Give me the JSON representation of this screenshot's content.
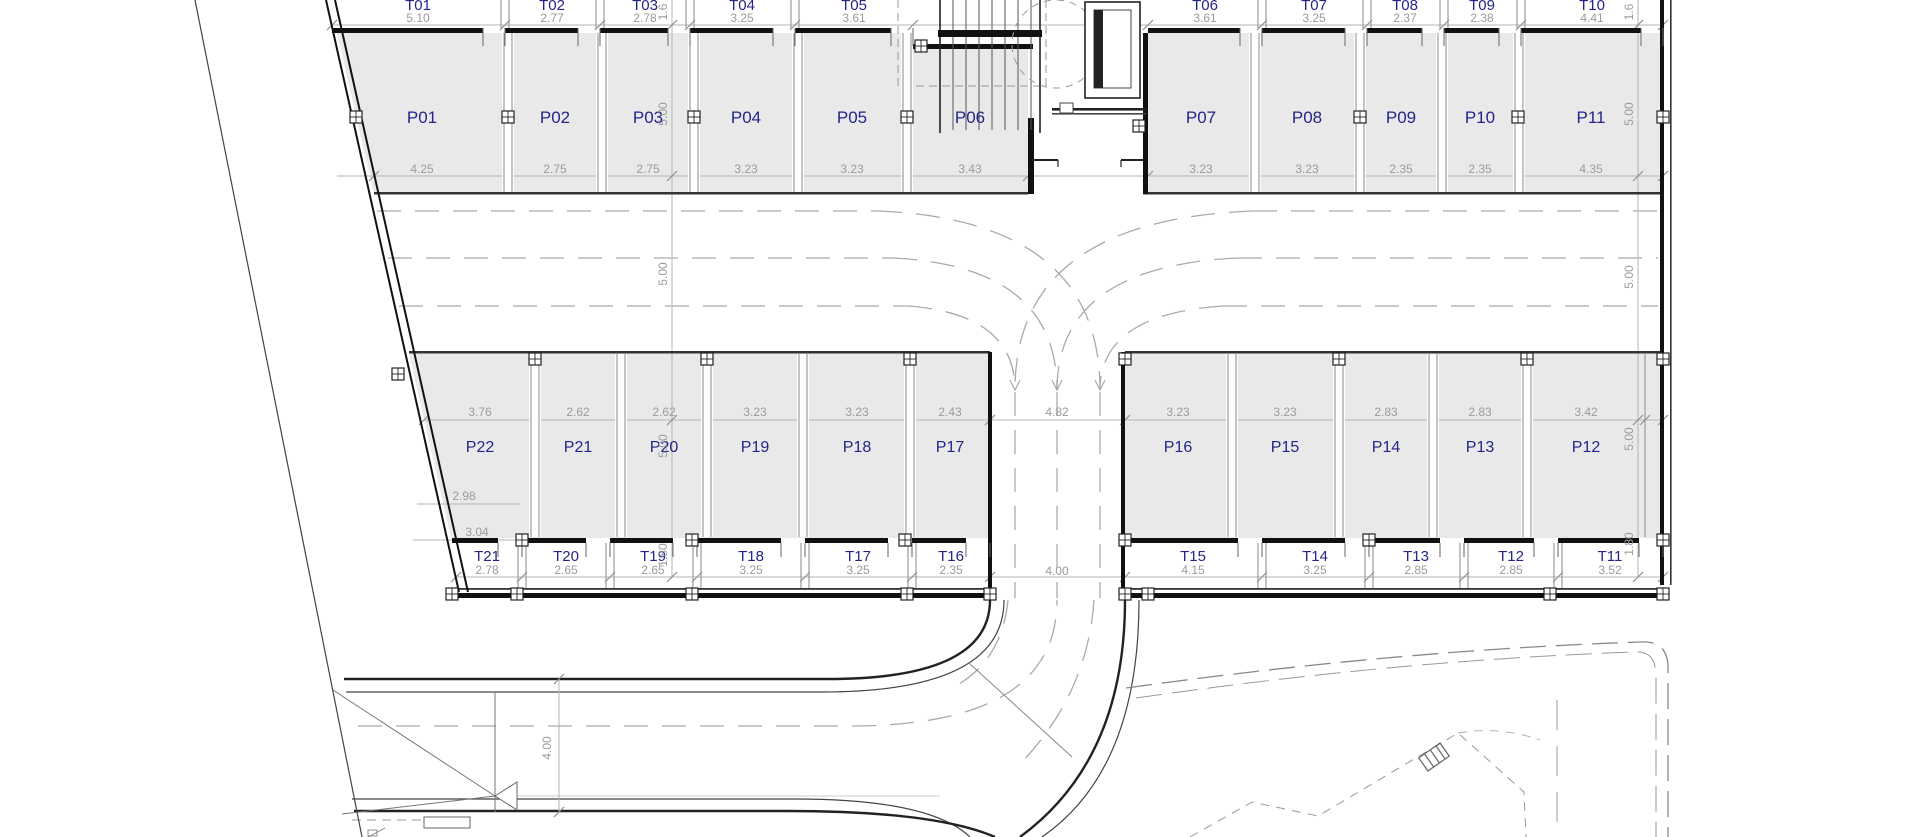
{
  "plan": {
    "title": "parking-level-floor-plan",
    "top_storage_row": [
      {
        "id": "T01",
        "w": "5.10"
      },
      {
        "id": "T02",
        "w": "2.77"
      },
      {
        "id": "T03",
        "w": "2.78"
      },
      {
        "id": "T04",
        "w": "3.25"
      },
      {
        "id": "T05",
        "w": "3.61"
      },
      {
        "id": "T06",
        "w": "3.61"
      },
      {
        "id": "T07",
        "w": "3.25"
      },
      {
        "id": "T08",
        "w": "2.37"
      },
      {
        "id": "T09",
        "w": "2.38"
      },
      {
        "id": "T10",
        "w": "4.41"
      }
    ],
    "top_parking_row": [
      {
        "id": "P01",
        "w": "4.25"
      },
      {
        "id": "P02",
        "w": "2.75"
      },
      {
        "id": "P03",
        "w": "2.75"
      },
      {
        "id": "P04",
        "w": "3.23"
      },
      {
        "id": "P05",
        "w": "3.23"
      },
      {
        "id": "P06",
        "w": "3.43"
      },
      {
        "id": "P07",
        "w": "3.23"
      },
      {
        "id": "P08",
        "w": "3.23"
      },
      {
        "id": "P09",
        "w": "2.35"
      },
      {
        "id": "P10",
        "w": "2.35"
      },
      {
        "id": "P11",
        "w": "4.35"
      }
    ],
    "bottom_parking_row": [
      {
        "id": "P22",
        "w": "3.76"
      },
      {
        "id": "P21",
        "w": "2.62"
      },
      {
        "id": "P20",
        "w": "2.62"
      },
      {
        "id": "P19",
        "w": "3.23"
      },
      {
        "id": "P18",
        "w": "3.23"
      },
      {
        "id": "P17",
        "w": "2.43"
      },
      {
        "id": "P16",
        "w": "3.23"
      },
      {
        "id": "P15",
        "w": "3.23"
      },
      {
        "id": "P14",
        "w": "2.83"
      },
      {
        "id": "P13",
        "w": "2.83"
      },
      {
        "id": "P12",
        "w": "3.42"
      }
    ],
    "bottom_storage_row": [
      {
        "id": "T21",
        "w": "2.78"
      },
      {
        "id": "T20",
        "w": "2.65"
      },
      {
        "id": "T19",
        "w": "2.65"
      },
      {
        "id": "T18",
        "w": "3.25"
      },
      {
        "id": "T17",
        "w": "3.25"
      },
      {
        "id": "T16",
        "w": "2.35"
      },
      {
        "id": "T15",
        "w": "4.15"
      },
      {
        "id": "T14",
        "w": "3.25"
      },
      {
        "id": "T13",
        "w": "2.85"
      },
      {
        "id": "T12",
        "w": "2.85"
      },
      {
        "id": "T11",
        "w": "3.52"
      }
    ],
    "left_dims": [
      "1.6",
      "5.00",
      "5.00",
      "5.00",
      "1.80"
    ],
    "right_dims": [
      "1.6",
      "5.00",
      "5.00",
      "5.00",
      "1.80"
    ],
    "extra_dims": {
      "center_lane_width": "4.82",
      "ramp_width": "4.00",
      "road_width": "4.00",
      "p22_depth_a": "2.98",
      "p22_depth_b": "3.04"
    },
    "colors": {
      "unit_label": "#24248a",
      "dim_text": "#9b9b9b",
      "cell_fill": "#e9e9e9",
      "wall": "#111111",
      "lane_dash": "#aaaaaa"
    }
  }
}
